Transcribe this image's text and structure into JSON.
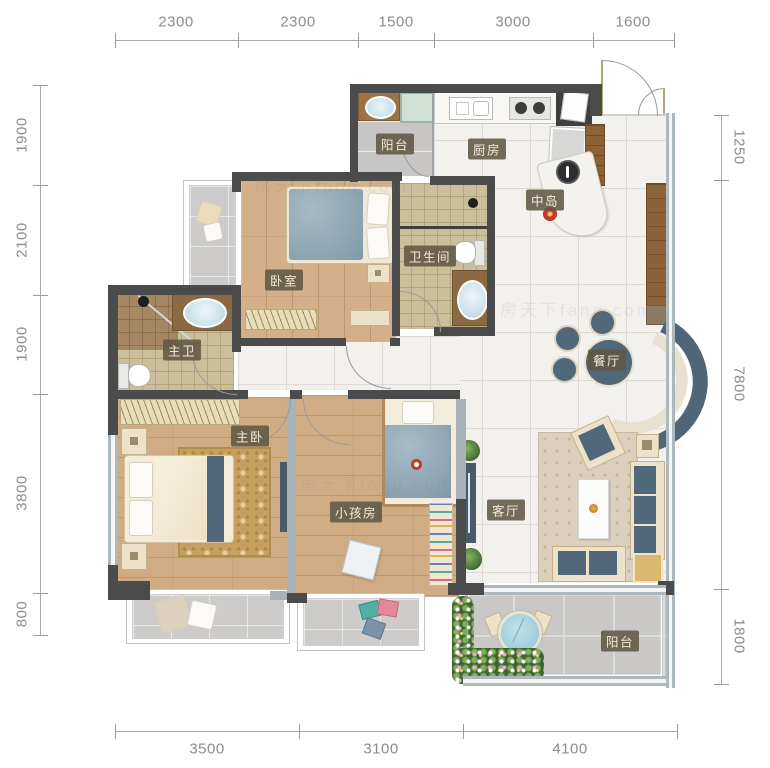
{
  "title": "三室两厅户型图",
  "watermark": "房天下fang.com",
  "labels": {
    "balcony_top": "阳台",
    "kitchen": "厨房",
    "island": "中岛",
    "bedroom": "卧室",
    "bathroom": "卫生间",
    "master_bath": "主卫",
    "master_bedroom": "主卧",
    "kids_room": "小孩房",
    "living_room": "客厅",
    "dining_room": "餐厅",
    "balcony_bottom": "阳台"
  },
  "dims": {
    "top": [
      "2300",
      "2300",
      "1500",
      "3000",
      "1600"
    ],
    "bottom": [
      "3500",
      "3100",
      "4100"
    ],
    "left": [
      "1900",
      "2100",
      "1900",
      "3800",
      "800"
    ],
    "right": [
      "1250",
      "7800",
      "1800"
    ]
  },
  "colors": {
    "wall_dark": "#4b4b4b",
    "wall_window": "#adb7be",
    "label_bg": "#605844",
    "label_text": "#f3ecd8",
    "wood_floor": "#d3b089",
    "tile_white": "#f3f1ee",
    "tile_beige": "#cabf9b",
    "tile_grey": "#c9c8c6",
    "accent_blue": "#51677a",
    "dim_text": "#8c8c8c"
  },
  "icons": {
    "bed": "bed-icon",
    "toilet": "toilet-icon",
    "washbasin": "washbasin-icon",
    "washing_machine": "washing-machine-icon",
    "sink": "sink-icon",
    "stove": "stove-icon",
    "fridge": "fridge-icon",
    "sofa": "sofa-icon",
    "plant": "plant-icon",
    "table": "table-icon"
  }
}
